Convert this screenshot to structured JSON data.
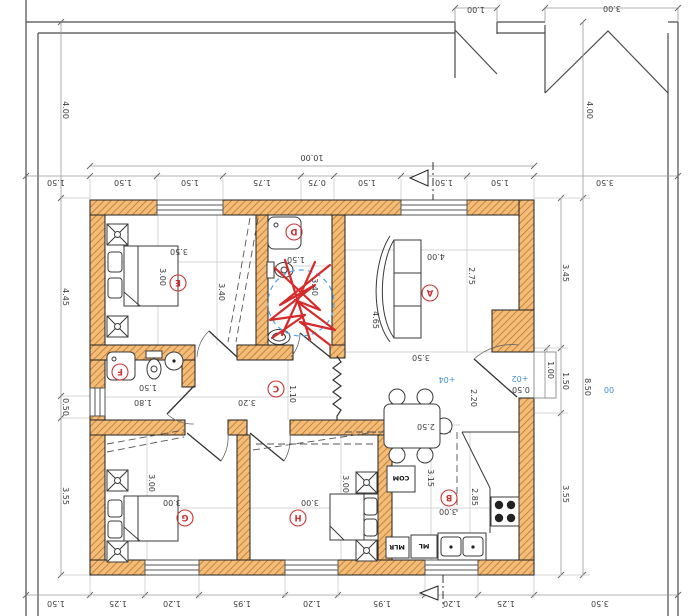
{
  "colors": {
    "wall_fill": "#f2bc79",
    "wall_hatch": "#c2762a",
    "dim_text": "#3c3c3c",
    "room_label_red": "#cc3333",
    "elevation_blue": "#3f8fd2",
    "markup_red": "#d62b2b",
    "markup_blue": "#4da3e8"
  },
  "rooms": {
    "a": "A",
    "b": "B",
    "c": "C",
    "d": "D",
    "e": "E",
    "f": "F",
    "g": "G",
    "h": "H"
  },
  "appliances": {
    "com": "COM",
    "ml": "ML",
    "mlr": "MLR"
  },
  "elevations": {
    "p04": "+04",
    "p02": "+02",
    "zero": "00"
  },
  "dims": {
    "top_outer": [
      "1.00",
      "3.00"
    ],
    "top_total": "10.00",
    "top_row": [
      "1.50",
      "1.50",
      "1.50",
      "1.75",
      "0.75",
      "1.50",
      "1.50",
      "1.50",
      "3.50"
    ],
    "bottom_row": [
      "1.50",
      "1.25",
      "1.20",
      "1.95",
      "1.20",
      "1.95",
      "1.20",
      "1.25",
      "3.50"
    ],
    "left_col": [
      "4.00",
      "4.45",
      "0.50",
      "3.55"
    ],
    "right_col": [
      "4.00",
      "3.45",
      "1.00",
      "1.50",
      "8.50",
      "3.55"
    ],
    "landing": "0.50",
    "room_e": [
      "3.50",
      "3.00",
      "3.40"
    ],
    "room_d": [
      "1.50",
      "3.40"
    ],
    "room_a": [
      "4.00",
      "2.75",
      "4.65",
      "3.50"
    ],
    "room_c": [
      "3.20",
      "1.10",
      "1.50",
      "1.80"
    ],
    "room_g": [
      "3.00",
      "3.00"
    ],
    "room_h": [
      "3.00",
      "3.00"
    ],
    "room_b": [
      "3.15",
      "2.85",
      "3.00",
      "2.50",
      "2.20"
    ]
  }
}
